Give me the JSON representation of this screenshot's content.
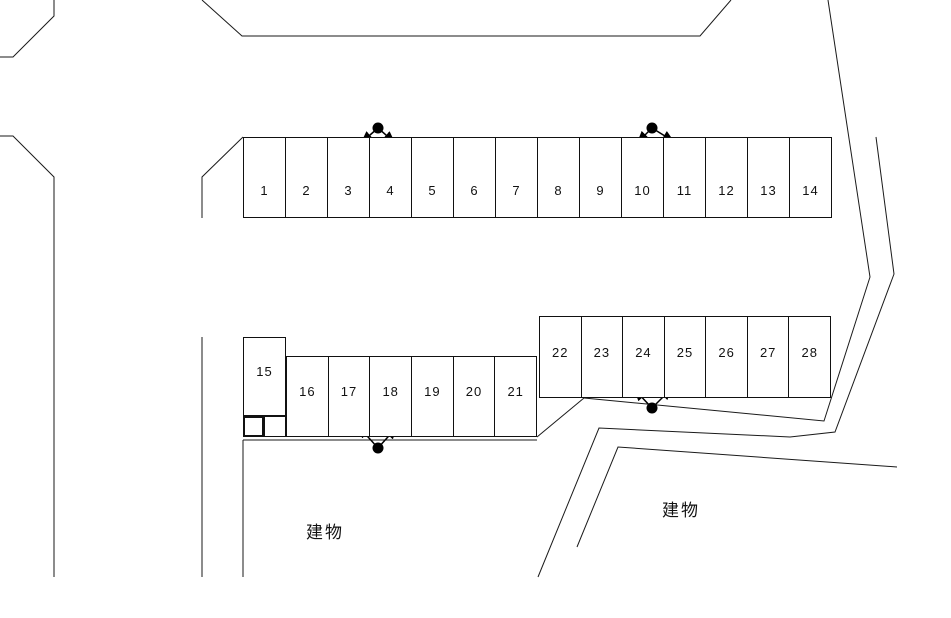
{
  "diagram": {
    "type": "parking-lot-layout-map",
    "building_labels": [
      {
        "id": "building-left",
        "text": "建物"
      },
      {
        "id": "building-right",
        "text": "建物"
      }
    ],
    "rows": [
      {
        "id": "row-1-14",
        "spaces": [
          "1",
          "2",
          "3",
          "4",
          "5",
          "6",
          "7",
          "8",
          "9",
          "10",
          "11",
          "12",
          "13",
          "14"
        ]
      },
      {
        "id": "space-15",
        "spaces": [
          "15"
        ]
      },
      {
        "id": "row-16-21",
        "spaces": [
          "16",
          "17",
          "18",
          "19",
          "20",
          "21"
        ]
      },
      {
        "id": "row-22-28",
        "spaces": [
          "22",
          "23",
          "24",
          "25",
          "26",
          "27",
          "28"
        ]
      }
    ],
    "dot_arrow_markers": [
      {
        "id": "marker-top-left",
        "location": "above row between spaces 3 and 4"
      },
      {
        "id": "marker-top-right",
        "location": "above row between spaces 10 and 11"
      },
      {
        "id": "marker-bottom-right",
        "location": "below row between spaces 24 and 25"
      },
      {
        "id": "marker-bottom-left",
        "location": "below row between spaces 17 and 18"
      }
    ],
    "colors": {
      "line": "#1a1a1a",
      "marker": "#000000",
      "background": "#ffffff"
    }
  }
}
